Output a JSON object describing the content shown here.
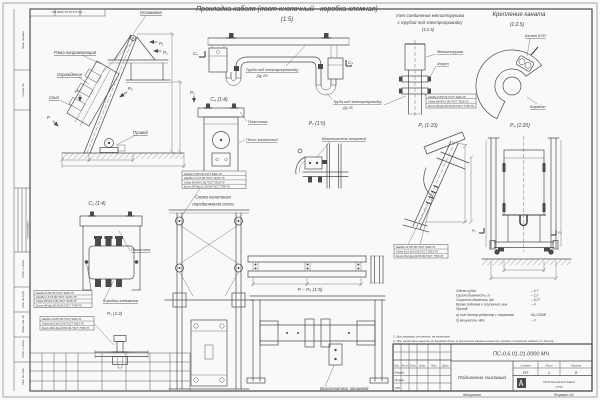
{
  "sheet": {
    "copied": "Копировал",
    "format": "Формат А2"
  },
  "header": {
    "title": "Прокладка кабеля (пост кнопочный - коробка клемная)",
    "scale": "(1:5)"
  },
  "side": {
    "osnovanie": "Основание",
    "rama": "Рама направляющая",
    "ograzhdenie": "Ограждение",
    "skip": "Скип",
    "privod": "Привод",
    "marks": {
      "p": "Р",
      "p1": "Р₁",
      "p2": "Р₂",
      "p3": "Р₃",
      "p4": "Р₄"
    }
  },
  "main": {
    "pipe": "Труба под электропроводку",
    "du": "Ду 25",
    "mark_left": "С₄",
    "mark_right": "С₃"
  },
  "node": {
    "title1": "Узел соединения металлорукава",
    "title2": "с трубой под электропроводку",
    "scale": "(1:2.5)",
    "hose": "Металлорукав",
    "clamp": "Хомут",
    "pipe": "Труба под электропроводку",
    "du": "Ду 25"
  },
  "rope": {
    "title": "Крепление каната",
    "scale": "(1:2.5)",
    "cable": "Канат 8.00",
    "drum": "Барабан"
  },
  "views": {
    "c4": {
      "label": "С₄ (1:4)",
      "plate": "Пластина",
      "post": "Пост кнопочный"
    },
    "c3": {
      "label": "С₃ (1:4)",
      "plate": "Пластина",
      "box": "Коробка клеммная"
    },
    "p2": {
      "label": "Р₂ (1:2)"
    },
    "p7": {
      "label": "Р₇ (1:5)",
      "switch": "Выключатель концевой"
    },
    "p1": {
      "label": "Р₁ (1:10)"
    },
    "p3": {
      "label": "Р₃ (1:20)",
      "mark": "Р₇"
    },
    "pp4": {
      "label": "Р – Р₄ (1:5)"
    },
    "scheme": {
      "title1": "Схема канатного",
      "title2": "передвижения скипа"
    },
    "bottom": {
      "swit": "Выключатель концевой"
    }
  },
  "callouts": {
    "m5": [
      "Шайба 5.65Г.06 ГОСТ 6402-70",
      "Шайба С.5.37.06 ГОСТ 11371-78",
      "Гайка М5-6Н.5.06 ГОСТ 5915-70",
      "Болт М5-6g×12.58.06 ГОСТ 7798-70"
    ],
    "m8": [
      "Шайба 8.65Г.06 ГОСТ 6402-70",
      "Шайба С.8.37.06 ГОСТ 11371-78",
      "Гайка М8-6Н.5.06 ГОСТ 5915-70",
      "Болт М8-6g×30.58.06 ГОСТ 7798-70"
    ],
    "m10": [
      "Шайба 10.65Г.06 ГОСТ 6402-70",
      "Гайка М10-6Н.5.06 ГОСТ 5915-70",
      "Болт М10-6g×40.58.06 ГОСТ 7798-70"
    ],
    "m6": [
      "Шайба 6.65Г.06 ГОСТ 6402-70",
      "Гайка М6-6Н.5.06 ГОСТ 5915-70",
      "Болт М6-6g×16.58.06 ГОСТ 7798-70"
    ],
    "m12": [
      "Шайба 12.65Г.06 ГОСТ 6402-70",
      "Гайка М12-6Н.5.06 ГОСТ 5915-70",
      "Болт М12-6g×40.58.06 ГОСТ 7798-70"
    ]
  },
  "specs": [
    {
      "label": "Объем кубля",
      "value": "– 0,7"
    },
    {
      "label": "Грузоподъемность, т",
      "value": "– 1,0"
    },
    {
      "label": "Скорость движения, м/с",
      "value": "– 0,27"
    },
    {
      "label": "Время подъема и опускания, мин",
      "value": "– 4"
    },
    {
      "label": "Привод:",
      "value": ""
    },
    {
      "label": "а) тип Мотор-редуктор с тормозом",
      "value": "КЦ 2000В"
    },
    {
      "label": "б) мощность, кВт",
      "value": "– 3"
    }
  ],
  "notes": [
    "1. Все размеры уточнять на монтаже.",
    "2. При запасовке каната на барабан болт А крепления каната нанести клеймо положения кабеля 2 и болта."
  ],
  "title_block": {
    "doc_number": "ПС-0.6.01.01.0000 МЧ",
    "doc_name": "Подъемник скиповый",
    "stage_h": "Стадия",
    "sheet_h": "Лист",
    "sheets_h": "Листов",
    "stage": "РП",
    "sheet_no": "1",
    "sheets": "8",
    "company1": "ООО Копейский Завод",
    "company2": "«УГЛ»",
    "cols": [
      "Изм.",
      "Кол.уч",
      "Лист",
      "№док.",
      "Подп.",
      "Дата"
    ],
    "rows": [
      "Разраб.",
      "Провер.",
      "ГИП"
    ]
  },
  "stamps": [
    "Перв. примен.",
    "Справ. №",
    "Согласовано",
    "Подп. и дата",
    "Инв. № дубл.",
    "Взам. инв. №",
    "Подп. и дата",
    "Инв. № подл."
  ]
}
